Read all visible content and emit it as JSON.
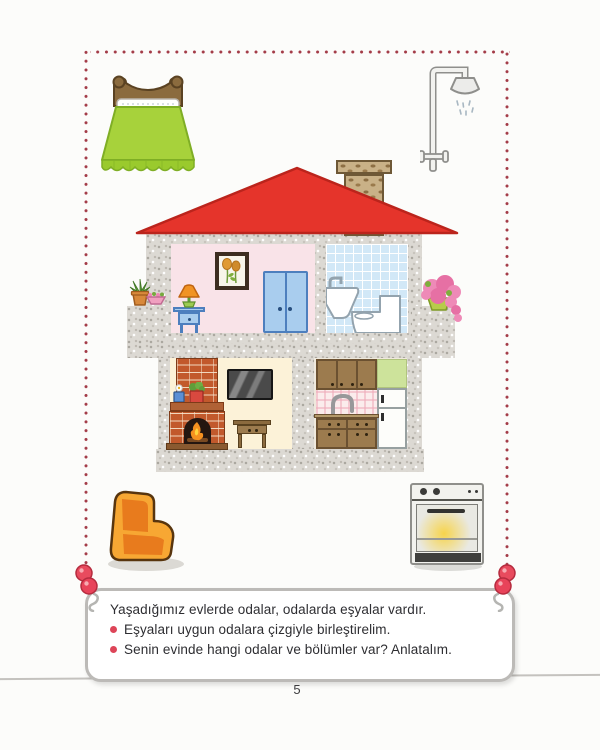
{
  "page": {
    "number": "5"
  },
  "instruction_box": {
    "intro": "Yaşadığımız evlerde odalar, odalarda eşyalar vardır.",
    "bullets": [
      "Eşyaları uygun odalara çizgiyle birleştirelim.",
      "Senin evinde hangi odalar ve bölümler var? Anlatalım."
    ]
  },
  "house": {
    "rooms": {
      "bedroom": {
        "items": [
          "framed-picture",
          "table-lamp",
          "nightstand",
          "wardrobe"
        ]
      },
      "bathroom": {
        "items": [
          "washbasin",
          "toilet"
        ]
      },
      "living_room": {
        "items": [
          "fireplace",
          "mantel-plants",
          "wall-tv",
          "console-table"
        ]
      },
      "kitchen": {
        "items": [
          "upper-cabinets",
          "sink-faucet",
          "refrigerator",
          "lower-cabinets"
        ]
      }
    },
    "exterior": [
      "red-roof",
      "brick-chimney",
      "left-balcony-plants",
      "right-balcony-flowers"
    ]
  },
  "loose_items": [
    "bed",
    "shower",
    "armchair",
    "oven"
  ],
  "colors": {
    "roof": "#e5342b",
    "wall_gray": "#dcd9d3",
    "bedroom_wall": "#f9e3e8",
    "bathroom_tile": "#d2e8f7",
    "living_wall": "#fcf2d8",
    "cabinet_brown": "#9c7b4e",
    "bed_green": "#a7d23b",
    "armchair_orange": "#f7a733",
    "border_dots": "#a33b47",
    "bullet": "#dd4558",
    "berries": "#e84b5e"
  }
}
